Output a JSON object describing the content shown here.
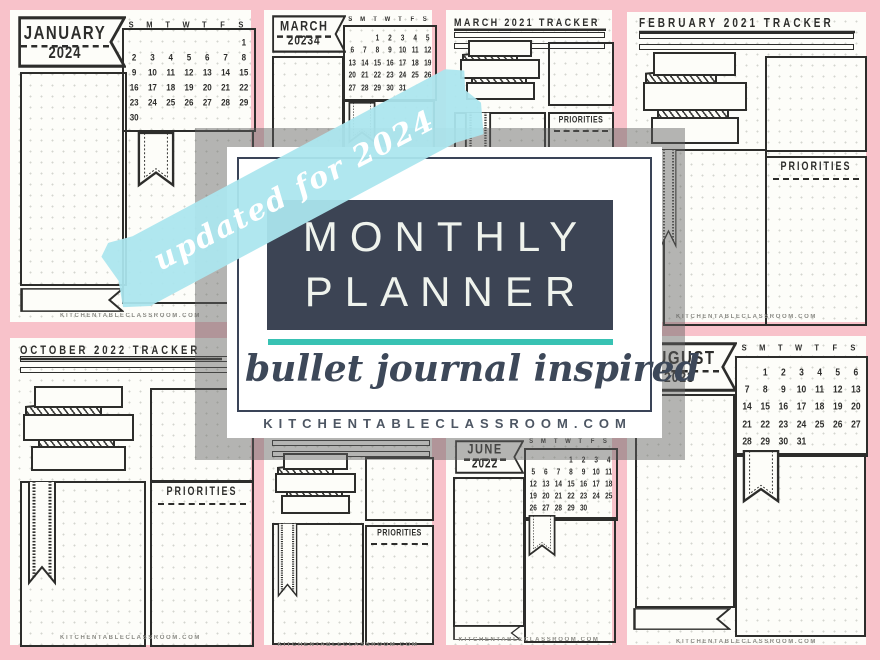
{
  "colors": {
    "pink_bg": "#f8c2ca",
    "tape_blue": "#abe5ee",
    "navy": "#3c4454",
    "teal": "#38c2b3",
    "ink": "#2d2d2b",
    "gray_overlay": "rgba(97,97,97,0.47)"
  },
  "tape": {
    "label": "updated for 2024"
  },
  "card": {
    "title1": "MONTHLY",
    "title2": "PLANNER",
    "subtitle": "bullet journal inspired",
    "site": "KITCHENTABLECLASSROOM.COM"
  },
  "labels": {
    "priorities": "PRIORITIES",
    "site": "KITCHENTABLECLASSROOM.COM"
  },
  "weekdays": [
    "S",
    "M",
    "T",
    "W",
    "T",
    "F",
    "S"
  ],
  "pages": {
    "january": {
      "month": "JANUARY",
      "year": "2024",
      "weeks": [
        [
          "",
          "",
          "",
          "",
          "",
          "",
          "1"
        ],
        [
          "2",
          "3",
          "4",
          "5",
          "6",
          "7",
          "8"
        ],
        [
          "9",
          "10",
          "11",
          "12",
          "13",
          "14",
          "15"
        ],
        [
          "16",
          "17",
          "18",
          "19",
          "20",
          "21",
          "22"
        ],
        [
          "23",
          "24",
          "25",
          "26",
          "27",
          "28",
          "29"
        ],
        [
          "30",
          "",
          "",
          "",
          "",
          "",
          ""
        ]
      ]
    },
    "march": {
      "month": "MARCH",
      "year": "20234",
      "weeks": [
        [
          "",
          "",
          "1",
          "2",
          "3",
          "4",
          "5"
        ],
        [
          "6",
          "7",
          "8",
          "9",
          "10",
          "11",
          "12"
        ],
        [
          "13",
          "14",
          "15",
          "16",
          "17",
          "18",
          "19"
        ],
        [
          "20",
          "21",
          "22",
          "23",
          "24",
          "25",
          "26"
        ],
        [
          "27",
          "28",
          "29",
          "30",
          "31",
          "",
          ""
        ]
      ]
    },
    "march_tracker": {
      "title": "MARCH 2021 TRACKER"
    },
    "february_tracker": {
      "title": "FEBRUARY 2021 TRACKER"
    },
    "october_tracker": {
      "title": "OCTOBER 2022 TRACKER"
    },
    "june": {
      "month": "JUNE",
      "year": "2022",
      "weeks": [
        [
          "",
          "",
          "",
          "1",
          "2",
          "3",
          "4"
        ],
        [
          "5",
          "6",
          "7",
          "8",
          "9",
          "10",
          "11"
        ],
        [
          "12",
          "13",
          "14",
          "15",
          "16",
          "17",
          "18"
        ],
        [
          "19",
          "20",
          "21",
          "22",
          "23",
          "24",
          "25"
        ],
        [
          "26",
          "27",
          "28",
          "29",
          "30",
          "",
          ""
        ]
      ]
    },
    "august": {
      "month": "AUGUST",
      "year": "2023",
      "weeks": [
        [
          "",
          "1",
          "2",
          "3",
          "4",
          "5",
          "6"
        ],
        [
          "7",
          "8",
          "9",
          "10",
          "11",
          "12",
          "13"
        ],
        [
          "14",
          "15",
          "16",
          "17",
          "18",
          "19",
          "20"
        ],
        [
          "21",
          "22",
          "23",
          "24",
          "25",
          "26",
          "27"
        ],
        [
          "28",
          "29",
          "30",
          "31",
          "",
          "",
          ""
        ]
      ]
    }
  }
}
